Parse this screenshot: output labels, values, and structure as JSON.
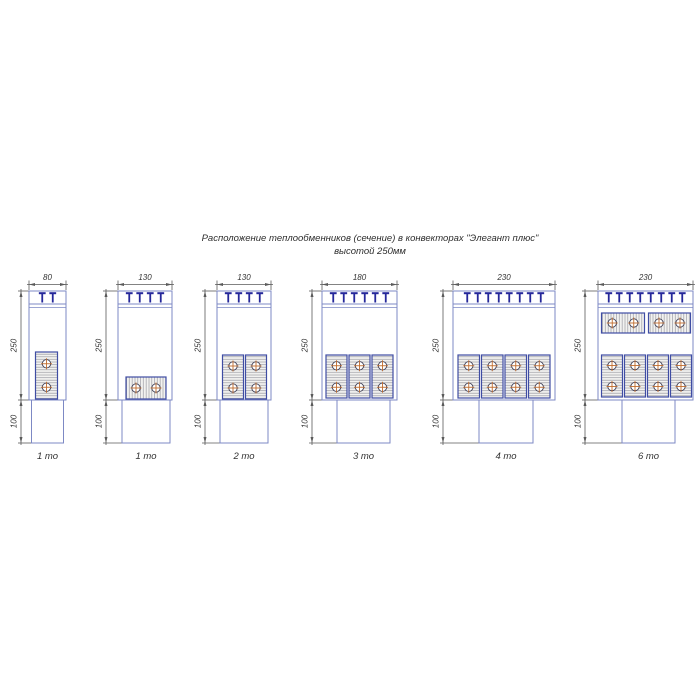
{
  "title": {
    "line1": "Расположение теплообменников (сечение) в конвекторах \"Элегант плюс\"",
    "line2": "высотой 250мм"
  },
  "colors": {
    "box_outline": "#7d89c4",
    "block_border": "#3f4da3",
    "block_fill": "#f2f2f0",
    "hatch_line": "#9c9ca4",
    "grille_clip": "#24279a",
    "dim_line": "#5a5a5a",
    "dim_text": "#333333",
    "circle_ring": "#3f3f55",
    "circle_cross": "#c06c2e"
  },
  "layout": {
    "box_top": 291,
    "box_bottom": 400,
    "duct_bottom": 443,
    "dim_line_y": 284.5,
    "dim_text_y": 280,
    "label_y": 459,
    "grille_line1": 304,
    "grille_line2": 307.5
  },
  "diagrams": [
    {
      "label": "1 то",
      "dim_width": "80",
      "dim_height": "250",
      "dim_duct": "100",
      "teeth": 2,
      "box_x": 29,
      "box_w": 37,
      "duct_x": 31.5,
      "duct_w": 32,
      "dim_x": 21,
      "blocks": [
        {
          "x": 35.5,
          "y": 352,
          "w": 22,
          "h": 47,
          "hatch": "h",
          "rows": 2,
          "cols": 1
        }
      ]
    },
    {
      "label": "1 то",
      "dim_width": "130",
      "dim_height": "250",
      "dim_duct": "100",
      "teeth": 4,
      "box_x": 118,
      "box_w": 54,
      "duct_x": 122,
      "duct_w": 48,
      "dim_x": 106,
      "blocks": [
        {
          "x": 126,
          "y": 377,
          "w": 40,
          "h": 22,
          "hatch": "v",
          "rows": 1,
          "cols": 2
        }
      ]
    },
    {
      "label": "2 то",
      "dim_width": "130",
      "dim_height": "250",
      "dim_duct": "100",
      "teeth": 4,
      "box_x": 217,
      "box_w": 54,
      "duct_x": 220,
      "duct_w": 48,
      "dim_x": 205,
      "blocks": [
        {
          "x": 222.5,
          "y": 355,
          "w": 21,
          "h": 44,
          "hatch": "h",
          "rows": 2,
          "cols": 1
        },
        {
          "x": 245.5,
          "y": 355,
          "w": 21,
          "h": 44,
          "hatch": "h",
          "rows": 2,
          "cols": 1
        }
      ]
    },
    {
      "label": "3 то",
      "dim_width": "180",
      "dim_height": "250",
      "dim_duct": "100",
      "teeth": 6,
      "box_x": 322,
      "box_w": 75,
      "duct_x": 337,
      "duct_w": 53,
      "dim_x": 312,
      "blocks": [
        {
          "x": 326,
          "y": 355,
          "w": 21,
          "h": 43,
          "hatch": "h",
          "rows": 2,
          "cols": 1
        },
        {
          "x": 349,
          "y": 355,
          "w": 21,
          "h": 43,
          "hatch": "h",
          "rows": 2,
          "cols": 1
        },
        {
          "x": 372,
          "y": 355,
          "w": 21,
          "h": 43,
          "hatch": "h",
          "rows": 2,
          "cols": 1
        }
      ]
    },
    {
      "label": "4 то",
      "dim_width": "230",
      "dim_height": "250",
      "dim_duct": "100",
      "teeth": 8,
      "box_x": 453,
      "box_w": 102,
      "duct_x": 479,
      "duct_w": 54,
      "dim_x": 443,
      "blocks": [
        {
          "x": 458,
          "y": 355,
          "w": 21.5,
          "h": 43,
          "hatch": "h",
          "rows": 2,
          "cols": 1
        },
        {
          "x": 481.5,
          "y": 355,
          "w": 21.5,
          "h": 43,
          "hatch": "h",
          "rows": 2,
          "cols": 1
        },
        {
          "x": 505,
          "y": 355,
          "w": 21.5,
          "h": 43,
          "hatch": "h",
          "rows": 2,
          "cols": 1
        },
        {
          "x": 528.5,
          "y": 355,
          "w": 21.5,
          "h": 43,
          "hatch": "h",
          "rows": 2,
          "cols": 1
        }
      ]
    },
    {
      "label": "6 то",
      "dim_width": "230",
      "dim_height": "250",
      "dim_duct": "100",
      "teeth": 8,
      "box_x": 598,
      "box_w": 95,
      "duct_x": 622,
      "duct_w": 53,
      "dim_x": 585,
      "blocks": [
        {
          "x": 601.5,
          "y": 313,
          "w": 43,
          "h": 20,
          "hatch": "v",
          "rows": 1,
          "cols": 2
        },
        {
          "x": 648.5,
          "y": 313,
          "w": 42,
          "h": 20,
          "hatch": "v",
          "rows": 1,
          "cols": 2
        },
        {
          "x": 601.5,
          "y": 355,
          "w": 21,
          "h": 42,
          "hatch": "h",
          "rows": 2,
          "cols": 1
        },
        {
          "x": 624.5,
          "y": 355,
          "w": 21,
          "h": 42,
          "hatch": "h",
          "rows": 2,
          "cols": 1
        },
        {
          "x": 647.5,
          "y": 355,
          "w": 21,
          "h": 42,
          "hatch": "h",
          "rows": 2,
          "cols": 1
        },
        {
          "x": 670.5,
          "y": 355,
          "w": 21,
          "h": 42,
          "hatch": "h",
          "rows": 2,
          "cols": 1
        }
      ]
    }
  ]
}
